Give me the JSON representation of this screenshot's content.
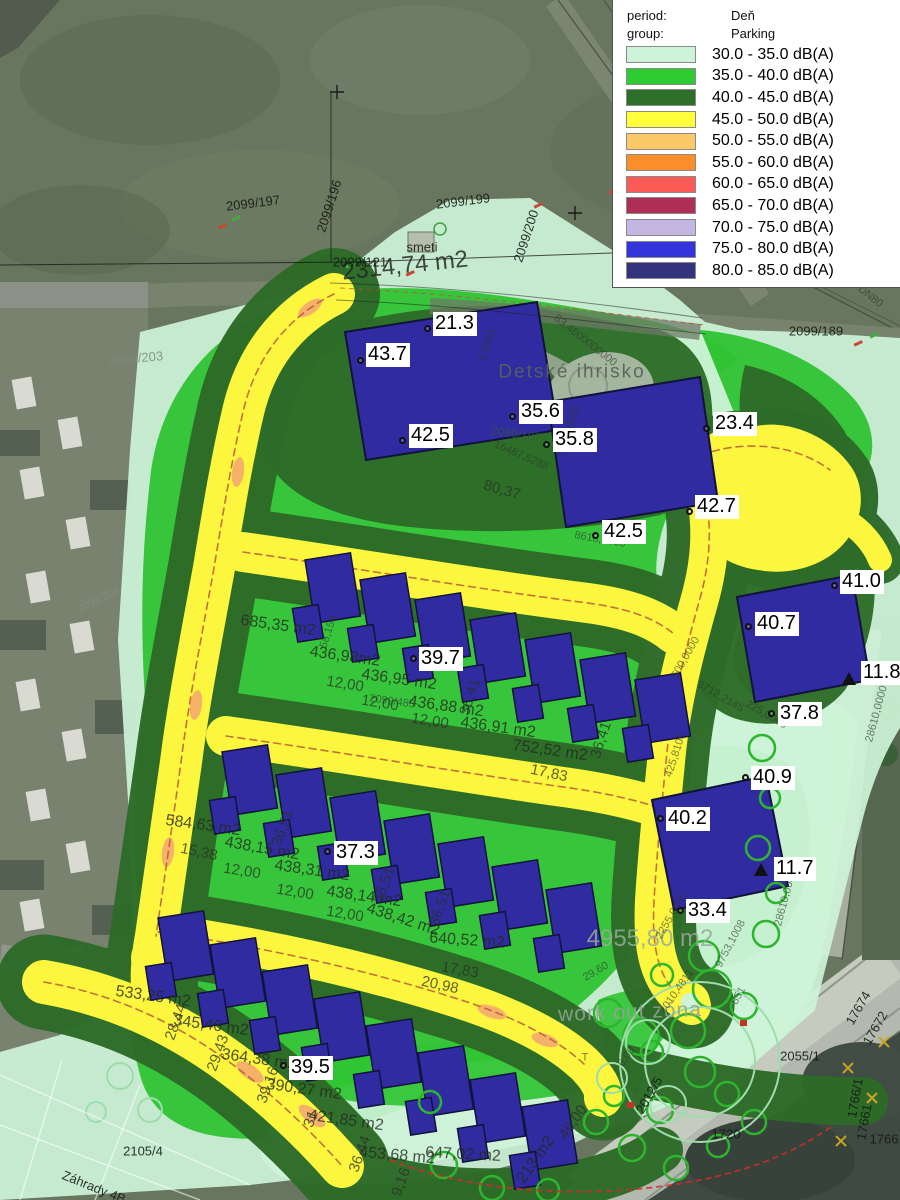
{
  "legend": {
    "period_label": "period:",
    "period_value": "Deň",
    "group_label": "group:",
    "group_value": "Parking",
    "entries": [
      {
        "range": "30.0 - 35.0 dB(A)",
        "color": "#cdf4d9"
      },
      {
        "range": "35.0 - 40.0 dB(A)",
        "color": "#2fcb32"
      },
      {
        "range": "40.0 - 45.0 dB(A)",
        "color": "#2e6f2a"
      },
      {
        "range": "45.0 - 50.0 dB(A)",
        "color": "#ffff3b"
      },
      {
        "range": "50.0 - 55.0 dB(A)",
        "color": "#fcc968"
      },
      {
        "range": "55.0 - 60.0 dB(A)",
        "color": "#fb8e28"
      },
      {
        "range": "60.0 - 65.0 dB(A)",
        "color": "#fa5b57"
      },
      {
        "range": "65.0 - 70.0 dB(A)",
        "color": "#ae2e55"
      },
      {
        "range": "70.0 - 75.0 dB(A)",
        "color": "#c3b6e2"
      },
      {
        "range": "75.0 - 80.0 dB(A)",
        "color": "#3434dd"
      },
      {
        "range": "80.0 - 85.0 dB(A)",
        "color": "#34347e"
      }
    ]
  },
  "colors": {
    "map_light_green": "#cdf3d8",
    "map_bright_green": "#2fc433",
    "map_dark_green": "#2d6b28",
    "map_road_yellow": "#fdf63e",
    "map_orange": "#f5b06a",
    "building": "#302ba0",
    "satellite_base": "#68765f"
  },
  "measurements": [
    {
      "v": "21.3",
      "bx": 433,
      "by": 312,
      "mx": 428,
      "my": 329,
      "mk": "c"
    },
    {
      "v": "43.7",
      "bx": 366,
      "by": 343,
      "mx": 361,
      "my": 361,
      "mk": "c"
    },
    {
      "v": "42.5",
      "bx": 409,
      "by": 424,
      "mx": 403,
      "my": 441,
      "mk": "c"
    },
    {
      "v": "35.6",
      "bx": 519,
      "by": 400,
      "mx": 513,
      "my": 417,
      "mk": "c"
    },
    {
      "v": "35.8",
      "bx": 553,
      "by": 428,
      "mx": 547,
      "my": 445,
      "mk": "c"
    },
    {
      "v": "23.4",
      "bx": 713,
      "by": 412,
      "mx": 707,
      "my": 429,
      "mk": "c"
    },
    {
      "v": "42.7",
      "bx": 695,
      "by": 495,
      "mx": 690,
      "my": 512,
      "mk": "c"
    },
    {
      "v": "42.5",
      "bx": 602,
      "by": 520,
      "mx": 596,
      "my": 536,
      "mk": "c"
    },
    {
      "v": "41.0",
      "bx": 840,
      "by": 570,
      "mx": 835,
      "my": 586,
      "mk": "c"
    },
    {
      "v": "40.7",
      "bx": 755,
      "by": 612,
      "mx": 749,
      "my": 627,
      "mk": "c"
    },
    {
      "v": "11.8",
      "bx": 861,
      "by": 661,
      "mx": 849,
      "my": 683,
      "mk": "t"
    },
    {
      "v": "37.8",
      "bx": 778,
      "by": 702,
      "mx": 772,
      "my": 714,
      "mk": "c"
    },
    {
      "v": "40.9",
      "bx": 751,
      "by": 766,
      "mx": 746,
      "my": 778,
      "mk": "c"
    },
    {
      "v": "40.2",
      "bx": 666,
      "by": 807,
      "mx": 661,
      "my": 819,
      "mk": "c"
    },
    {
      "v": "11.7",
      "bx": 774,
      "by": 857,
      "mx": 761,
      "my": 874,
      "mk": "t"
    },
    {
      "v": "33.4",
      "bx": 686,
      "by": 899,
      "mx": 681,
      "my": 911,
      "mk": "c"
    },
    {
      "v": "39.7",
      "bx": 419,
      "by": 647,
      "mx": 414,
      "my": 659,
      "mk": "c"
    },
    {
      "v": "37.3",
      "bx": 334,
      "by": 841,
      "mx": 328,
      "my": 852,
      "mk": "c"
    },
    {
      "v": "39.5",
      "bx": 289,
      "by": 1056,
      "mx": 284,
      "my": 1066,
      "mk": "c"
    }
  ],
  "labels": [
    {
      "t": "2314,74 m2",
      "x": 405,
      "y": 266,
      "r": -6,
      "c": "ab"
    },
    {
      "t": "685,35 m2",
      "x": 278,
      "y": 626,
      "r": 8,
      "c": "a"
    },
    {
      "t": "436,98m2",
      "x": 345,
      "y": 657,
      "r": 8,
      "c": "a"
    },
    {
      "t": "436,95 m2",
      "x": 399,
      "y": 680,
      "r": 8,
      "c": "a"
    },
    {
      "t": "436,88 m2",
      "x": 446,
      "y": 707,
      "r": 8,
      "c": "a"
    },
    {
      "t": "436,91 m2",
      "x": 498,
      "y": 728,
      "r": 8,
      "c": "a"
    },
    {
      "t": "752,52 m2",
      "x": 550,
      "y": 751,
      "r": 8,
      "c": "a"
    },
    {
      "t": "584,63 m2",
      "x": 203,
      "y": 826,
      "r": 8,
      "c": "a"
    },
    {
      "t": "438,15 m2",
      "x": 262,
      "y": 849,
      "r": 10,
      "c": "a"
    },
    {
      "t": "438,31 m2",
      "x": 312,
      "y": 871,
      "r": 8,
      "c": "a"
    },
    {
      "t": "438,14 m2",
      "x": 364,
      "y": 897,
      "r": 8,
      "c": "a"
    },
    {
      "t": "438,42 m2",
      "x": 403,
      "y": 920,
      "r": 18,
      "c": "a"
    },
    {
      "t": "640,52 m2",
      "x": 467,
      "y": 941,
      "r": 4,
      "c": "a"
    },
    {
      "t": "533,25 m2",
      "x": 153,
      "y": 997,
      "r": 8,
      "c": "a"
    },
    {
      "t": "345,46 m2",
      "x": 211,
      "y": 1026,
      "r": 8,
      "c": "a"
    },
    {
      "t": "364,38 m2",
      "x": 259,
      "y": 1060,
      "r": 8,
      "c": "a"
    },
    {
      "t": "390,27 m2",
      "x": 304,
      "y": 1090,
      "r": 8,
      "c": "a"
    },
    {
      "t": "421,85 m2",
      "x": 346,
      "y": 1121,
      "r": 8,
      "c": "a"
    },
    {
      "t": "453,68 m2",
      "x": 397,
      "y": 1156,
      "r": 5,
      "c": "a"
    },
    {
      "t": "647,02 m2",
      "x": 463,
      "y": 1155,
      "r": 3,
      "c": "a"
    },
    {
      "t": "4955,80 m2",
      "x": 650,
      "y": 939,
      "r": 0,
      "c": "L"
    },
    {
      "t": "213 m2",
      "x": 536,
      "y": 1160,
      "r": -55,
      "c": "a"
    },
    {
      "t": "Detské ihrisko",
      "x": 572,
      "y": 372,
      "r": 0,
      "c": "g"
    },
    {
      "t": "work out zóna",
      "x": 630,
      "y": 1012,
      "r": -2,
      "c": "Lg"
    },
    {
      "t": "smeti",
      "x": 422,
      "y": 247,
      "r": 0,
      "c": "p"
    },
    {
      "t": "80,37",
      "x": 502,
      "y": 490,
      "r": 16,
      "c": "d"
    },
    {
      "t": "17,83",
      "x": 549,
      "y": 773,
      "r": 12,
      "c": "d"
    },
    {
      "t": "17,83",
      "x": 460,
      "y": 970,
      "r": 10,
      "c": "d"
    },
    {
      "t": "20,98",
      "x": 440,
      "y": 985,
      "r": 12,
      "c": "d"
    },
    {
      "t": "15,38",
      "x": 199,
      "y": 852,
      "r": 12,
      "c": "d"
    },
    {
      "t": "12,00",
      "x": 345,
      "y": 684,
      "r": 9,
      "c": "d"
    },
    {
      "t": "12,00",
      "x": 380,
      "y": 703,
      "r": 9,
      "c": "d"
    },
    {
      "t": "12,00",
      "x": 430,
      "y": 721,
      "r": 9,
      "c": "d"
    },
    {
      "t": "12,00",
      "x": 242,
      "y": 871,
      "r": 9,
      "c": "d"
    },
    {
      "t": "12,00",
      "x": 295,
      "y": 892,
      "r": 9,
      "c": "d"
    },
    {
      "t": "12,00",
      "x": 345,
      "y": 914,
      "r": 9,
      "c": "d"
    },
    {
      "t": "36,41",
      "x": 470,
      "y": 697,
      "r": -72,
      "c": "d"
    },
    {
      "t": "36,41",
      "x": 601,
      "y": 740,
      "r": -72,
      "c": "d"
    },
    {
      "t": "58,158",
      "x": 329,
      "y": 632,
      "r": -72,
      "c": "t"
    },
    {
      "t": "36,51",
      "x": 283,
      "y": 828,
      "r": -70,
      "c": "d"
    },
    {
      "t": "36,51",
      "x": 384,
      "y": 885,
      "r": -70,
      "c": "d"
    },
    {
      "t": "36,51",
      "x": 440,
      "y": 908,
      "r": -70,
      "c": "d"
    },
    {
      "t": "29,43",
      "x": 218,
      "y": 1053,
      "r": -70,
      "c": "d"
    },
    {
      "t": "28,44",
      "x": 176,
      "y": 1022,
      "r": -70,
      "c": "d"
    },
    {
      "t": "39,16",
      "x": 268,
      "y": 1085,
      "r": -70,
      "c": "d"
    },
    {
      "t": "31",
      "x": 311,
      "y": 1119,
      "r": -70,
      "c": "d"
    },
    {
      "t": "36,44",
      "x": 360,
      "y": 1154,
      "r": -70,
      "c": "d"
    },
    {
      "t": "9,16",
      "x": 401,
      "y": 1182,
      "r": -70,
      "c": "d"
    },
    {
      "t": "46,00",
      "x": 573,
      "y": 1122,
      "r": -55,
      "c": "d"
    },
    {
      "t": "83,4600000000",
      "x": 585,
      "y": 341,
      "r": 38,
      "c": "t"
    },
    {
      "t": "9,9581",
      "x": 488,
      "y": 345,
      "r": -72,
      "c": "t"
    },
    {
      "t": "16487,5288",
      "x": 521,
      "y": 456,
      "r": 24,
      "c": "t"
    },
    {
      "t": "2550,0000",
      "x": 570,
      "y": 430,
      "r": -75,
      "c": "t"
    },
    {
      "t": "8618,0000",
      "x": 600,
      "y": 540,
      "r": 10,
      "c": "t"
    },
    {
      "t": "3712,2145",
      "x": 720,
      "y": 697,
      "r": 30,
      "c": "t"
    },
    {
      "t": "225,0000",
      "x": 766,
      "y": 715,
      "r": 30,
      "c": "t"
    },
    {
      "t": "600,0000",
      "x": 686,
      "y": 658,
      "r": -60,
      "c": "t"
    },
    {
      "t": "425,8100",
      "x": 676,
      "y": 755,
      "r": -72,
      "c": "t"
    },
    {
      "t": "28610,0000",
      "x": 877,
      "y": 714,
      "r": -75,
      "c": "t"
    },
    {
      "t": "28610,0000",
      "x": 786,
      "y": 898,
      "r": -75,
      "c": "t"
    },
    {
      "t": "9753,1008",
      "x": 731,
      "y": 944,
      "r": -62,
      "c": "t"
    },
    {
      "t": "2255,0000",
      "x": 672,
      "y": 916,
      "r": -60,
      "c": "t"
    },
    {
      "t": "2010,4811",
      "x": 677,
      "y": 992,
      "r": -55,
      "c": "t"
    },
    {
      "t": "851",
      "x": 739,
      "y": 996,
      "r": -60,
      "c": "t"
    },
    {
      "t": "29,60",
      "x": 596,
      "y": 972,
      "r": -30,
      "c": "t"
    },
    {
      "t": "6,00",
      "x": 627,
      "y": 1057,
      "r": -55,
      "c": "t"
    },
    {
      "t": "T",
      "x": 585,
      "y": 1058,
      "r": 0,
      "c": "t"
    },
    {
      "t": "Existujúci vodovod DN80",
      "x": 833,
      "y": 268,
      "r": 38,
      "c": "t"
    },
    {
      "t": "2099/197",
      "x": 253,
      "y": 203,
      "r": -7,
      "c": "p"
    },
    {
      "t": "2099/196",
      "x": 329,
      "y": 206,
      "r": -72,
      "c": "p"
    },
    {
      "t": "2099/199",
      "x": 463,
      "y": 201,
      "r": -7,
      "c": "p"
    },
    {
      "t": "2099/200",
      "x": 526,
      "y": 236,
      "r": -72,
      "c": "p"
    },
    {
      "t": "2099/121",
      "x": 360,
      "y": 262,
      "r": 0,
      "c": "p"
    },
    {
      "t": "2099/203",
      "x": 136,
      "y": 358,
      "r": -5,
      "c": "pl"
    },
    {
      "t": "2099/298",
      "x": 99,
      "y": 600,
      "r": -25,
      "c": "plf"
    },
    {
      "t": "2099/189",
      "x": 816,
      "y": 331,
      "r": 0,
      "c": "p"
    },
    {
      "t": "2099/187",
      "x": 516,
      "y": 434,
      "r": 8,
      "c": "pg"
    },
    {
      "t": "2099/485",
      "x": 392,
      "y": 702,
      "r": 8,
      "c": "t"
    },
    {
      "t": "2055/1",
      "x": 800,
      "y": 1056,
      "r": 0,
      "c": "p"
    },
    {
      "t": "2012/5",
      "x": 649,
      "y": 1095,
      "r": -60,
      "c": "p"
    },
    {
      "t": "17674",
      "x": 858,
      "y": 1008,
      "r": -60,
      "c": "p"
    },
    {
      "t": "17672",
      "x": 875,
      "y": 1028,
      "r": -60,
      "c": "p"
    },
    {
      "t": "1766/1",
      "x": 855,
      "y": 1098,
      "r": -80,
      "c": "p"
    },
    {
      "t": "17661",
      "x": 864,
      "y": 1122,
      "r": -80,
      "c": "p"
    },
    {
      "t": "1766",
      "x": 884,
      "y": 1139,
      "r": 0,
      "c": "p"
    },
    {
      "t": "1720",
      "x": 726,
      "y": 1134,
      "r": 0,
      "c": "p"
    },
    {
      "t": "2105/4",
      "x": 143,
      "y": 1151,
      "r": 0,
      "c": "p"
    },
    {
      "t": "Záhrady 4B",
      "x": 94,
      "y": 1187,
      "r": 22,
      "c": "p"
    }
  ]
}
